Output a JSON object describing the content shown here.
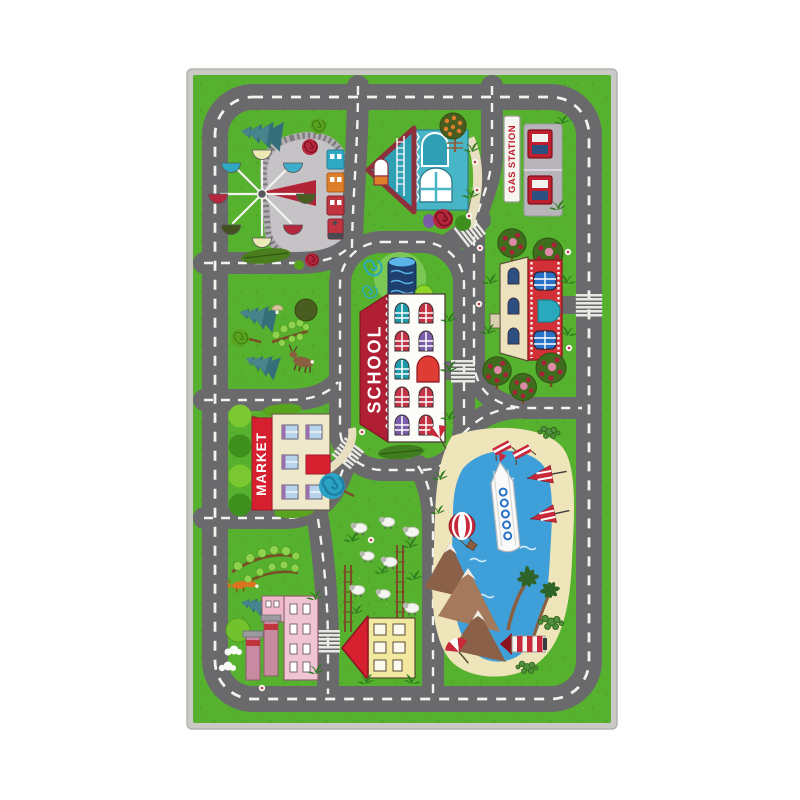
{
  "scene": {
    "description": "product photo of a kids road play rug on white background",
    "rug": {
      "labels": {
        "school": "SCHOOL",
        "market": "MARKET",
        "gas_station": "GAS STATION"
      },
      "colors": {
        "background": "#ffffff",
        "binding": "#cbc9c5",
        "grass": "#56b12e",
        "road": "#6a6a6c",
        "road_marking": "#f2f2ee",
        "park_ground": "#c6c3c7",
        "school_banner": "#b01f33",
        "school_text": "#ffffff",
        "market_banner": "#d62030",
        "market_text": "#ffffff",
        "gas_sign_bg": "#f7f5f0",
        "gas_sign_text": "#c01f2e",
        "lake_blue": "#3f9fd8",
        "sand": "#efe5bb",
        "stripe_red": "#c8293a"
      },
      "features": [
        "outer-ring-road",
        "inner-roads",
        "crosswalks",
        "ferris-wheel",
        "train-track",
        "train",
        "pine-trees",
        "lollipop-trees",
        "blue-house",
        "fruit-tree",
        "gas-station",
        "fuel-pumps",
        "school-building",
        "fountain",
        "market-building",
        "red-building",
        "apple-trees",
        "deer",
        "fox",
        "factory",
        "smoke-stacks",
        "sheep-meadow",
        "fences",
        "yellow-house",
        "lake",
        "beach",
        "cruise-ship",
        "sailboats",
        "hot-air-balloon",
        "mountains",
        "palm-trees",
        "lighthouse",
        "beach-umbrella",
        "beach-chairs",
        "cacti",
        "daisies",
        "shrubs"
      ]
    }
  }
}
